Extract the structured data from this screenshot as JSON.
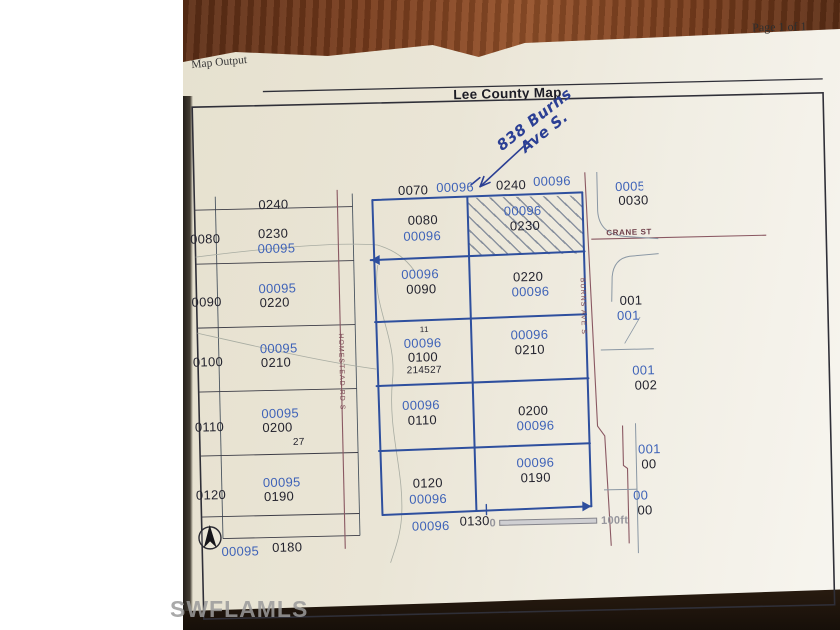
{
  "window": {
    "page_info": "Page 1 of 1",
    "doc_label": "Map Output",
    "watermark": "SWFLAMLS"
  },
  "map": {
    "title": "Lee County Map",
    "note": {
      "line1": "838 Burns",
      "line2": "Ave S."
    },
    "scale": {
      "zero": "0",
      "max": "100ft"
    },
    "streets": {
      "crane": "CRANE ST",
      "burns": "BURNS AVE S",
      "homestead": "HOMESTEAD RD S"
    },
    "left_col": {
      "top": "0240",
      "rows": [
        {
          "id": "0080",
          "black": "0230",
          "blue": "00095"
        },
        {
          "id": "0090",
          "blue": "00095",
          "black": "0220"
        },
        {
          "id": "0100",
          "blue": "00095",
          "black": "0210"
        },
        {
          "id": "0110",
          "blue": "00095",
          "black": "0200",
          "note": "27"
        },
        {
          "id": "0120",
          "blue": "00095",
          "black": "0190"
        }
      ],
      "bottom": {
        "blue": "00095",
        "black": "0180"
      }
    },
    "center": {
      "top1_black": "0070",
      "top1_blue": "00096",
      "top2_black": "0240",
      "top2_blue": "00096",
      "r1l": {
        "black": "0080",
        "blue": "00096"
      },
      "r1r": {
        "blue": "00096",
        "black": "0230"
      },
      "r2l": {
        "blue": "00096",
        "black": "0090"
      },
      "r2r": {
        "black": "0220",
        "blue": "00096"
      },
      "r3l": {
        "tiny": "11",
        "blue": "00096",
        "black": "0100",
        "strap": "214527"
      },
      "r3r": {
        "blue": "00096",
        "black": "0210"
      },
      "r4l": {
        "blue": "00096",
        "black": "0110"
      },
      "r4r": {
        "black": "0200",
        "blue": "00096"
      },
      "r5l": {
        "black": "0120",
        "blue": "00096"
      },
      "r5r": {
        "blue": "00096",
        "black": "0190"
      },
      "bottom_blue": "00096",
      "bottom_black": "0130"
    },
    "right": {
      "p1": {
        "l1": "0005",
        "l2": "0030"
      },
      "p2": {
        "l1": "001",
        "l2": "001"
      },
      "p3": {
        "l1": "001",
        "l2": "002"
      },
      "p4": {
        "l1": "001",
        "l2": "00"
      },
      "p5": {
        "l1": "00",
        "l2": "00"
      }
    }
  },
  "colors": {
    "ink_blue": "#2b3f94",
    "parcel_blue": "#3f63b8",
    "parcel_black": "#23232e",
    "road_maroon": "#8a5862",
    "traced_blue": "#2e4f9e",
    "paper": "#eae5d6",
    "wood": "#7a3d1d"
  }
}
